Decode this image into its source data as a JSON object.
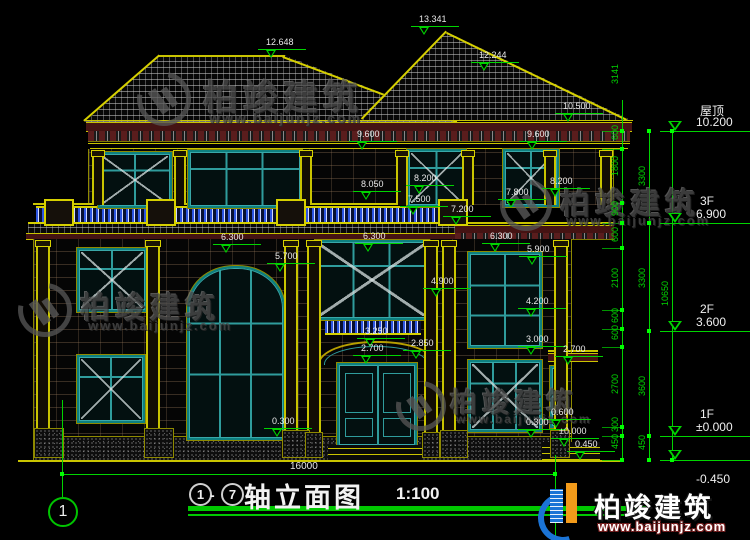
{
  "drawing": {
    "title_axis_start": "1",
    "title_axis_end": "7",
    "title_dash": "-",
    "title_name": "轴立面图",
    "title_scale": "1:100",
    "axis_bubble": "1",
    "overall_width_dim": "16000"
  },
  "levels": [
    {
      "label": "屋顶",
      "value": "10.200",
      "y": 131
    },
    {
      "label": "3F",
      "value": "6.900",
      "y": 223
    },
    {
      "label": "2F",
      "value": "3.600",
      "y": 331
    },
    {
      "label": "1F",
      "value": "±0.000",
      "y": 436
    },
    {
      "label": "",
      "value": "-0.450",
      "y": 460,
      "value_below": true
    }
  ],
  "facade_dims": [
    {
      "t": "12.648",
      "x": 288,
      "y": 44
    },
    {
      "t": "13.341",
      "x": 441,
      "y": 21
    },
    {
      "t": "12.244",
      "x": 501,
      "y": 57
    },
    {
      "t": "10.500",
      "x": 585,
      "y": 108
    },
    {
      "t": "9.600",
      "x": 379,
      "y": 136
    },
    {
      "t": "9.600",
      "x": 549,
      "y": 136
    },
    {
      "t": "8.050",
      "x": 383,
      "y": 186
    },
    {
      "t": "8.200",
      "x": 436,
      "y": 180
    },
    {
      "t": "8.200",
      "x": 572,
      "y": 183
    },
    {
      "t": "7.800",
      "x": 528,
      "y": 194
    },
    {
      "t": "7.500",
      "x": 430,
      "y": 201
    },
    {
      "t": "7.200",
      "x": 473,
      "y": 211
    },
    {
      "t": "6.300",
      "x": 243,
      "y": 239
    },
    {
      "t": "6.300",
      "x": 385,
      "y": 238
    },
    {
      "t": "6.300",
      "x": 512,
      "y": 238
    },
    {
      "t": "5.900",
      "x": 549,
      "y": 251
    },
    {
      "t": "5.700",
      "x": 297,
      "y": 258
    },
    {
      "t": "4.900",
      "x": 453,
      "y": 283
    },
    {
      "t": "4.200",
      "x": 548,
      "y": 303
    },
    {
      "t": "3.250",
      "x": 387,
      "y": 333
    },
    {
      "t": "3.000",
      "x": 548,
      "y": 341
    },
    {
      "t": "2.850",
      "x": 433,
      "y": 345
    },
    {
      "t": "2.700",
      "x": 383,
      "y": 350
    },
    {
      "t": "2.700",
      "x": 585,
      "y": 351
    },
    {
      "t": "0.600",
      "x": 573,
      "y": 414
    },
    {
      "t": "0.300",
      "x": 294,
      "y": 423
    },
    {
      "t": "0.300",
      "x": 548,
      "y": 424
    },
    {
      "t": "±0.000",
      "x": 581,
      "y": 433
    },
    {
      "t": "0.450",
      "x": 597,
      "y": 446
    }
  ],
  "chains": [
    {
      "x": 622,
      "labels": [
        [
          "3141",
          80
        ],
        [
          "600",
          141
        ],
        [
          "1800",
          172
        ],
        [
          "900",
          217
        ],
        [
          "600",
          243
        ],
        [
          "2100",
          284
        ],
        [
          "600",
          324
        ],
        [
          "600",
          341
        ],
        [
          "2700",
          390
        ],
        [
          "300",
          433
        ],
        [
          "450",
          450
        ]
      ]
    },
    {
      "x": 649,
      "labels": [
        [
          "3300",
          182
        ],
        [
          "3300",
          284
        ],
        [
          "3600",
          392
        ],
        [
          "450",
          451
        ]
      ]
    },
    {
      "x": 672,
      "labels": [
        [
          "10650",
          297
        ]
      ]
    }
  ],
  "watermark": {
    "text": "柏竣建筑",
    "url": "www.baijunjz.com"
  },
  "logo": {
    "text": "柏竣建筑",
    "url": "www.baijunjz.com"
  }
}
